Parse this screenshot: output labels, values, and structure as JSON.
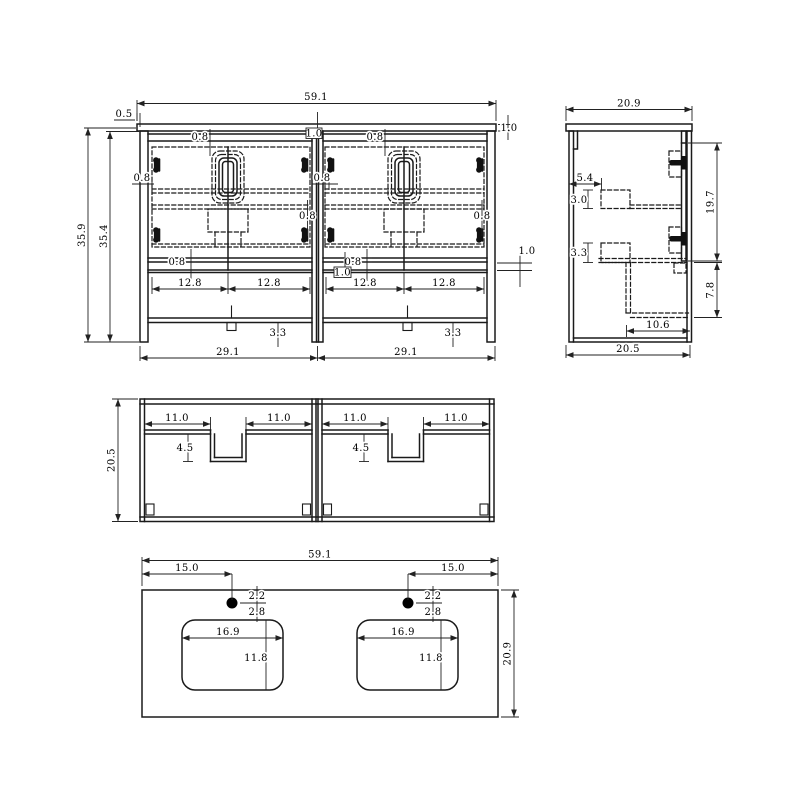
{
  "front": {
    "overall_width": "59.1",
    "overhang": "0.5",
    "total_height": "35.9",
    "carcass_height": "35.4",
    "top_thickness": "1.0",
    "reveal": "0.8",
    "center_stile": "1.0",
    "rail_thickness": "1.0",
    "door_width": "12.8",
    "shelf_height": "3.3",
    "unit_width": "29.1"
  },
  "side": {
    "top_depth": "20.9",
    "back_offset": "5.4",
    "upper_bracket": "3.0",
    "lower_bracket": "3.3",
    "door_height": "19.7",
    "shelf_opening": "7.8",
    "shelf_depth": "10.6",
    "base_depth": "20.5"
  },
  "plan": {
    "depth": "20.5",
    "side_panel": "11.0",
    "notch_depth": "4.5"
  },
  "counter": {
    "width": "59.1",
    "faucet_offset": "15.0",
    "faucet_to_edge": "2.2",
    "faucet_to_sink": "2.8",
    "sink_width": "16.9",
    "sink_depth": "11.8",
    "depth": "20.9"
  },
  "colors": {
    "background": "#ffffff",
    "line": "#1a1a1a",
    "dimension": "#222222"
  }
}
